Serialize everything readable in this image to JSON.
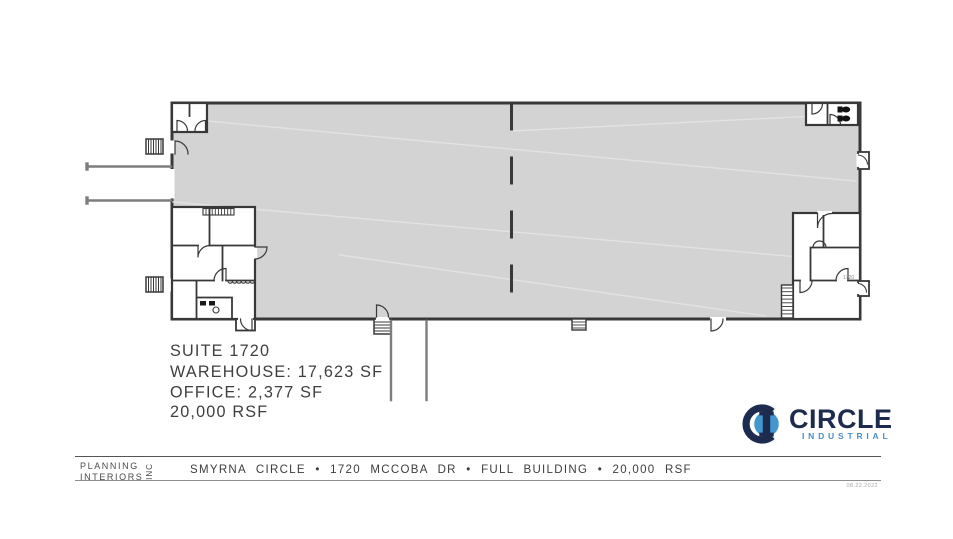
{
  "colors": {
    "warehouse_fill": "#d3d3d3",
    "wall": "#383838",
    "ramp": "#7d7d7d",
    "logo_navy": "#1d2c4e",
    "logo_blue": "#4396ce",
    "logo_subtitle_blue": "#4a8fc7"
  },
  "plan": {
    "suite": "SUITE 1720",
    "warehouse": "WAREHOUSE: 17,623 SF",
    "office": "OFFICE: 2,377 SF",
    "rsf": "20,000 RSF",
    "door_tag": "1720"
  },
  "logo": {
    "name": "CIRCLE",
    "subtitle": "INDUSTRIAL"
  },
  "footer": {
    "firm_line1": "PLANNING",
    "firm_line2": "INTERIORS",
    "firm_suffix": "INC",
    "project_line": "SMYRNA CIRCLE • 1720 MCCOBA DR • FULL BUILDING • 20,000 RSF",
    "date": "08.22.2022"
  }
}
